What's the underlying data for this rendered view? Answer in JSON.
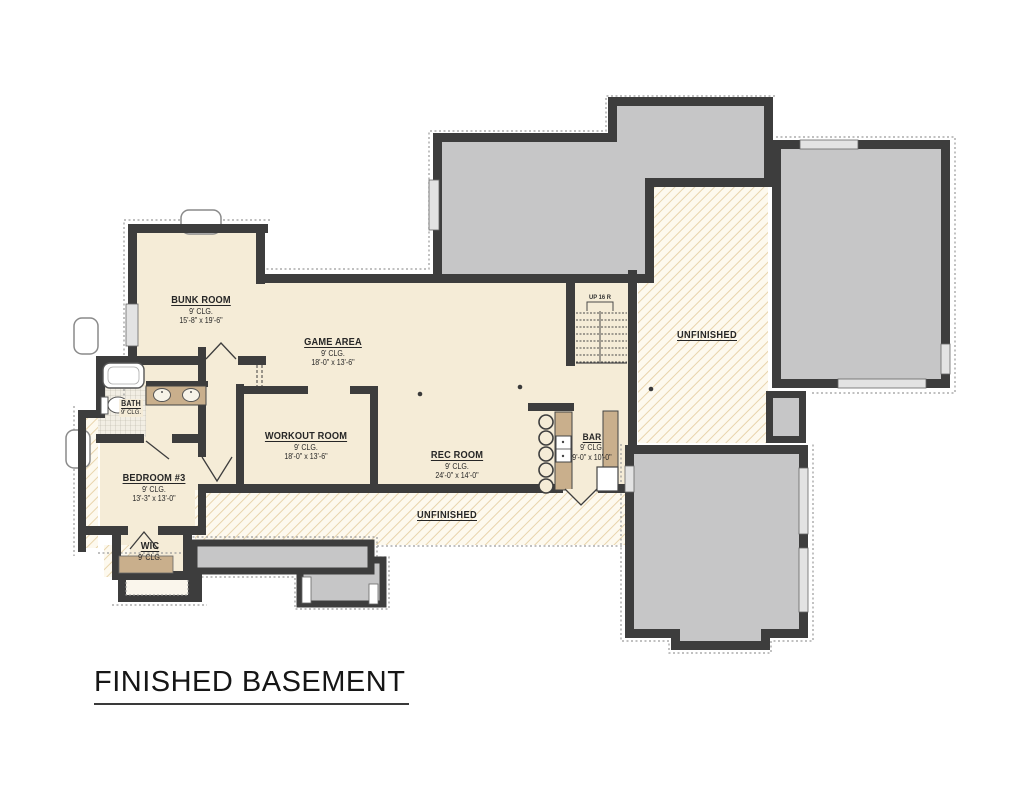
{
  "title": "FINISHED BASEMENT",
  "rooms": [
    {
      "id": "bunk-room",
      "name": "BUNK ROOM",
      "ceiling": "9' CLG.",
      "dims": "15'-8\" x 19'-6\""
    },
    {
      "id": "game-area",
      "name": "GAME AREA",
      "ceiling": "9' CLG.",
      "dims": "18'-0\" x 13'-6\""
    },
    {
      "id": "workout-room",
      "name": "WORKOUT ROOM",
      "ceiling": "9' CLG.",
      "dims": "18'-0\" x 13'-6\""
    },
    {
      "id": "rec-room",
      "name": "REC ROOM",
      "ceiling": "9' CLG.",
      "dims": "24'-0\" x 14'-0\""
    },
    {
      "id": "bar",
      "name": "BAR",
      "ceiling": "9' CLG.",
      "dims": "9'-0\" x 10'-0\""
    },
    {
      "id": "bath",
      "name": "BATH",
      "ceiling": "9' CLG.",
      "dims": ""
    },
    {
      "id": "bedroom-3",
      "name": "BEDROOM #3",
      "ceiling": "9' CLG.",
      "dims": "13'-3\" x 13'-0\""
    },
    {
      "id": "wic",
      "name": "WIC",
      "ceiling": "9' CLG.",
      "dims": ""
    }
  ],
  "unfinished_labels": {
    "right": "UNFINISHED",
    "bottom": "UNFINISHED"
  },
  "stairs_label": "UP 16 R",
  "colors": {
    "wall": "#3d3d3d",
    "finished_floor": "#f5ecd7",
    "unfinished_fill": "#c6c6c7",
    "hatch_line": "#e8d4ac",
    "counter": "#c9af8c"
  }
}
